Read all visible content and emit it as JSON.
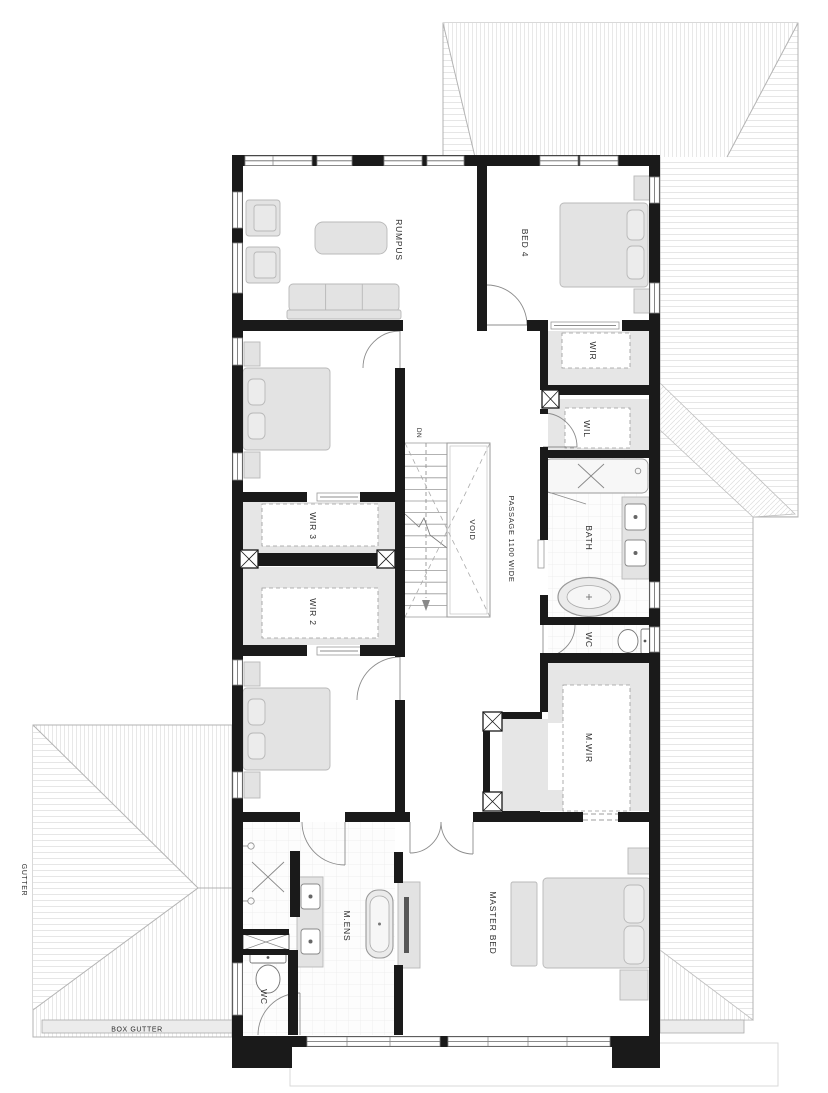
{
  "title": "Upper floor plan",
  "labels": {
    "rumpus": "RUMPUS",
    "bed4": "BED 4",
    "wir": "WIR",
    "wil": "WIL",
    "bath": "BATH",
    "wc_upper": "WC",
    "wir3": "WIR 3",
    "wir2": "WIR 2",
    "mwir": "M.WIR",
    "mens": "M.ENS",
    "master_bed": "MASTER BED",
    "wc_lower": "WC",
    "void": "VOID",
    "dn": "DN",
    "passage": "PASSAGE 1100 WIDE",
    "gutter": "GUTTER",
    "box_gutter": "BOX GUTTER"
  },
  "colors": {
    "wall": "#1a1a1a",
    "furniture_fill": "#e3e3e3",
    "furniture_stroke": "#b8b8b8",
    "closet_fill": "#e6e6e6",
    "roof_line": "#b3b3b3",
    "roof_hatch": "#e2e2e2",
    "gutter_fill": "#ececec",
    "tile_line": "#ececec",
    "dash_line": "#9a9a9a",
    "label_text": "#2b2b2b"
  }
}
